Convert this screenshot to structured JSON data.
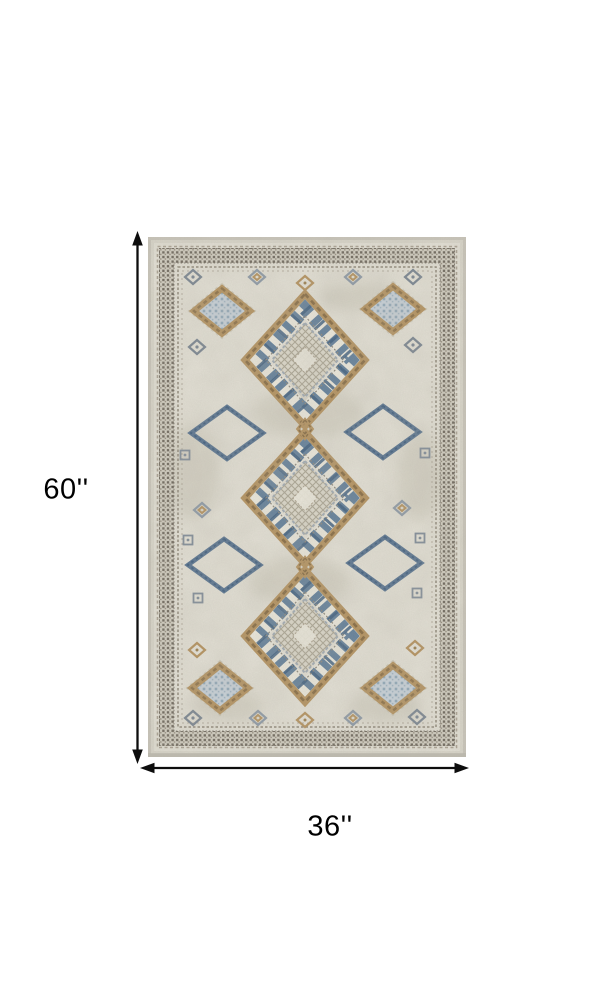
{
  "canvas": {
    "background": "#ffffff"
  },
  "dimension_annotations": {
    "height": {
      "label": "60''"
    },
    "width": {
      "label": "36''"
    },
    "arrow_color": "#0d0d0d"
  },
  "rug": {
    "kind": "geometric-diamond-area-rug",
    "palette": {
      "base": "#d9d6ca",
      "edge": "#c9c5ba",
      "field": "#e3e0d5",
      "bandBg": "#d2cec1",
      "bandDark": "#6b6459",
      "bandMid": "#8d8577",
      "line1": "#a89f90",
      "tan": "#b3905c",
      "tanDark": "#84683f",
      "blue": "#5f7d99",
      "blueDark": "#54708e",
      "blueDeep": "#3a5a7c",
      "blueLight": "#c7d1d9",
      "checkDot": "#8fa7b8",
      "hatchBg": "#dcd8ca",
      "hatchLine": "#aaa492",
      "cream": "#ece9dd",
      "blotch": "#c6c2b3",
      "pileEdge": "#b8b5a9"
    },
    "pattern": {
      "large_diamonds": [
        {
          "cx": 157,
          "cy": 123
        },
        {
          "cx": 157,
          "cy": 261
        },
        {
          "cx": 157,
          "cy": 399
        }
      ],
      "checker_diamonds": [
        {
          "cx": 74,
          "cy": 74
        },
        {
          "cx": 245,
          "cy": 72
        },
        {
          "cx": 72,
          "cy": 451
        },
        {
          "cx": 245,
          "cy": 451
        }
      ],
      "outline_diamonds": [
        {
          "cx": 79,
          "cy": 196
        },
        {
          "cx": 235,
          "cy": 195
        },
        {
          "cx": 76,
          "cy": 328
        },
        {
          "cx": 237,
          "cy": 326
        }
      ],
      "connectors": [
        {
          "cx": 157,
          "cy": 192
        },
        {
          "cx": 157,
          "cy": 330
        }
      ],
      "small_motifs": [
        {
          "cx": 45,
          "cy": 40,
          "kind": "g"
        },
        {
          "cx": 109,
          "cy": 40,
          "kind": "b"
        },
        {
          "cx": 157,
          "cy": 46,
          "kind": "t"
        },
        {
          "cx": 205,
          "cy": 40,
          "kind": "b"
        },
        {
          "cx": 265,
          "cy": 40,
          "kind": "g"
        },
        {
          "cx": 49,
          "cy": 110,
          "kind": "g"
        },
        {
          "cx": 265,
          "cy": 108,
          "kind": "g"
        },
        {
          "cx": 54,
          "cy": 273,
          "kind": "b"
        },
        {
          "cx": 254,
          "cy": 271,
          "kind": "b"
        },
        {
          "cx": 49,
          "cy": 413,
          "kind": "t"
        },
        {
          "cx": 267,
          "cy": 411,
          "kind": "t"
        },
        {
          "cx": 45,
          "cy": 481,
          "kind": "g"
        },
        {
          "cx": 110,
          "cy": 481,
          "kind": "b"
        },
        {
          "cx": 157,
          "cy": 483,
          "kind": "t"
        },
        {
          "cx": 205,
          "cy": 481,
          "kind": "b"
        },
        {
          "cx": 269,
          "cy": 480,
          "kind": "g"
        }
      ],
      "tiny_squares": [
        {
          "cx": 37,
          "cy": 218
        },
        {
          "cx": 277,
          "cy": 216
        },
        {
          "cx": 40,
          "cy": 303
        },
        {
          "cx": 272,
          "cy": 301
        },
        {
          "cx": 50,
          "cy": 361
        },
        {
          "cx": 269,
          "cy": 356
        }
      ]
    }
  }
}
